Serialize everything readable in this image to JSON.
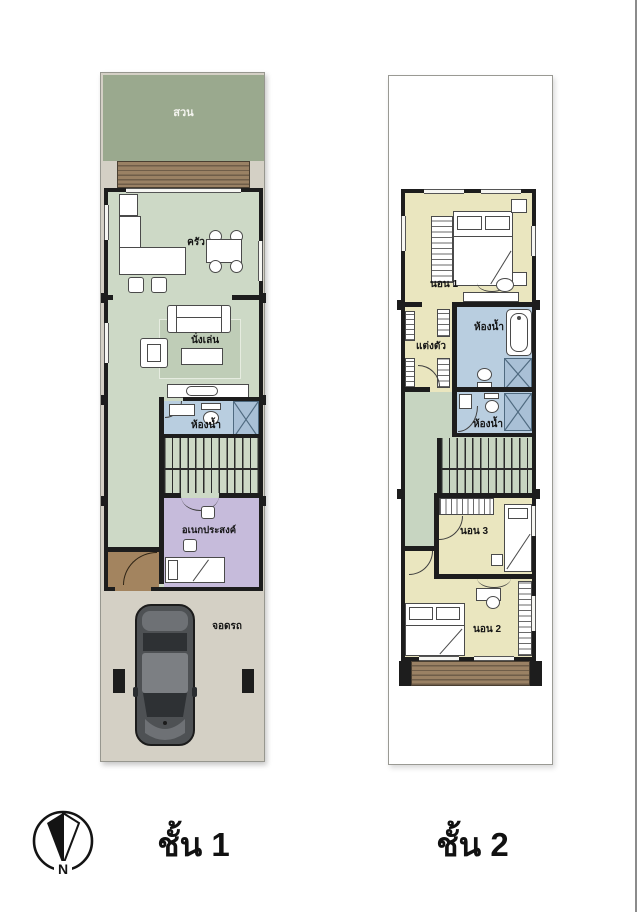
{
  "colors": {
    "lot_grey": "#d4d0c5",
    "garden_green": "#9aa98e",
    "room_green": "#cdd9c6",
    "hall_green": "#c7d5c1",
    "bath_blue": "#b9cee0",
    "shower_blue": "#a9c0d6",
    "multipurpose_purple": "#c6bbdb",
    "bedroom_yellow": "#eae6bf",
    "entry_brown": "#a3845f",
    "deck_brown": "#9a8164",
    "wall_black": "#1d1d1d"
  },
  "floor1": {
    "title": "ชั้น 1",
    "labels": {
      "garden": "สวน",
      "kitchen": "ครัว",
      "living": "นั่งเล่น",
      "bathroom": "ห้องน้ำ",
      "multipurpose": "อเนกประสงค์",
      "parking": "จอดรถ"
    }
  },
  "floor2": {
    "title": "ชั้น 2",
    "labels": {
      "bedroom1": "นอน 1",
      "dressing": "แต่งตัว",
      "bathroom_upper": "ห้องน้ำ",
      "bathroom_lower": "ห้องน้ำ",
      "bedroom3": "นอน 3",
      "bedroom2": "นอน 2"
    }
  },
  "compass": {
    "north": "N"
  }
}
